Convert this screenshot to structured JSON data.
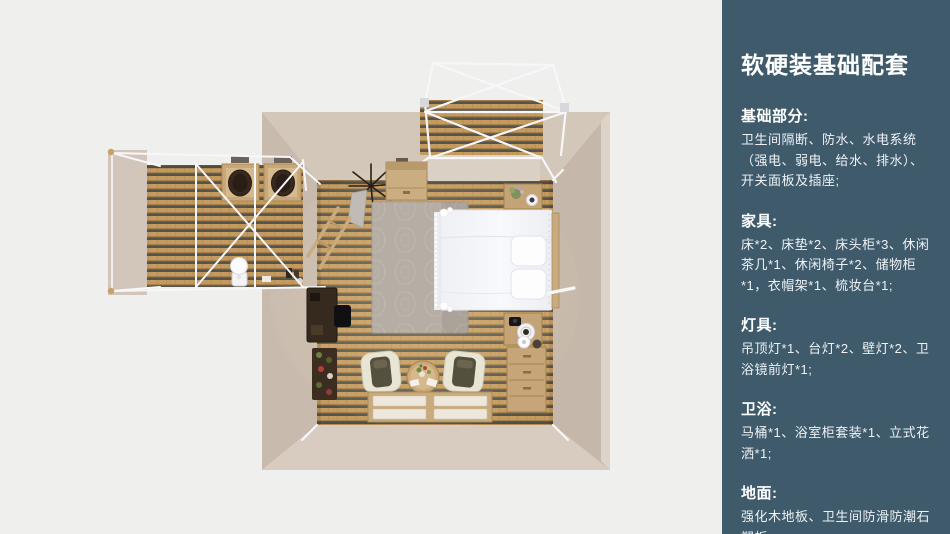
{
  "colors": {
    "background": "#efefee",
    "sidebar_bg": "#3e5a6b",
    "sidebar_text": "#ffffff",
    "sidebar_body_text": "#eef2f5",
    "wall_beige": "#cdc0b3",
    "wood_floor": "#c49a5f",
    "frame_white": "#f6f6f8",
    "bed_white": "#f3f4f7",
    "rug_gray": "#b6aea4"
  },
  "sidebar": {
    "title": "软硬装基础配套",
    "sections": [
      {
        "heading": "基础部分:",
        "body": "卫生间隔断、防水、水电系统（强电、弱电、给水、排水）、开关面板及插座;"
      },
      {
        "heading": "家具:",
        "body": "床*2、床垫*2、床头柜*3、休闲茶几*1、休闲椅子*2、储物柜*1，衣帽架*1、梳妆台*1;"
      },
      {
        "heading": "灯具:",
        "body": "吊顶灯*1、台灯*2、壁灯*2、卫浴镜前灯*1;"
      },
      {
        "heading": "卫浴:",
        "body": "马桶*1、浴室柜套装*1、立式花洒*1;"
      },
      {
        "heading": "地面:",
        "body": "强化木地板、卫生间防滑防潮石塑板;"
      }
    ]
  }
}
